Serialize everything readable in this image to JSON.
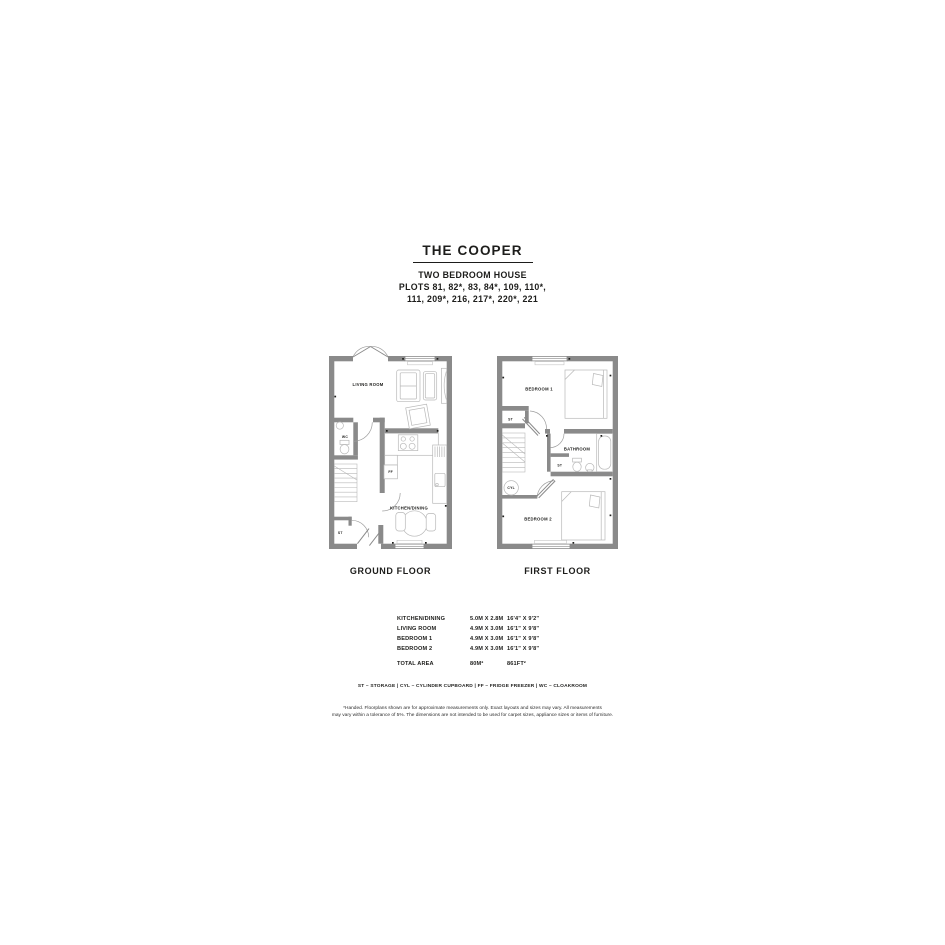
{
  "header": {
    "title": "THE COOPER",
    "subtitle": "TWO BEDROOM HOUSE",
    "plots_line1": "PLOTS 81, 82*, 83, 84*, 109, 110*,",
    "plots_line2": "111, 209*, 216, 217*, 220*, 221"
  },
  "plans": {
    "ground": {
      "caption": "GROUND FLOOR",
      "labels": {
        "living_room": "LIVING ROOM",
        "wc": "WC",
        "storage": "ST",
        "fridge_freezer": "FF",
        "kitchen_dining": "KITCHEN/DINING"
      }
    },
    "first": {
      "caption": "FIRST FLOOR",
      "labels": {
        "bedroom1": "BEDROOM 1",
        "storage_upper": "ST",
        "bathroom": "BATHROOM",
        "storage_landing": "ST",
        "cylinder": "CYL",
        "bedroom2": "BEDROOM 2"
      }
    }
  },
  "dimensions_table": {
    "rows": [
      {
        "room": "KITCHEN/DINING",
        "metric": "5.0M X 2.8M",
        "imperial": "16'4\" X 9'2\""
      },
      {
        "room": "LIVING ROOM",
        "metric": "4.9M X 3.0M",
        "imperial": "16'1\" X 9'8\""
      },
      {
        "room": "BEDROOM 1",
        "metric": "4.9M X 3.0M",
        "imperial": "16'1\" X 9'8\""
      },
      {
        "room": "BEDROOM 2",
        "metric": "4.9M X 3.0M",
        "imperial": "16'1\" X 9'8\""
      }
    ],
    "total": {
      "room": "TOTAL AREA",
      "metric": "80M²",
      "imperial": "861FT²"
    }
  },
  "legend": "ST – STORAGE   |   CYL – CYLINDER CUPBOARD   |   FF – FRIDGE FREEZER   |   WC – CLOAKROOM",
  "disclaimer": {
    "line1": "*Handed. Floorplans shown are for approximate measurements only. Exact layouts and sizes may vary. All measurements",
    "line2": "may vary within a tolerance of 5%. The dimensions are not intended to be used for carpet sizes, appliance sizes or items of furniture."
  },
  "colors": {
    "wall": "#8a8a8a",
    "fixture": "#b8b8b8",
    "door_arc": "#9d9d9d",
    "text": "#1d1d1b"
  }
}
